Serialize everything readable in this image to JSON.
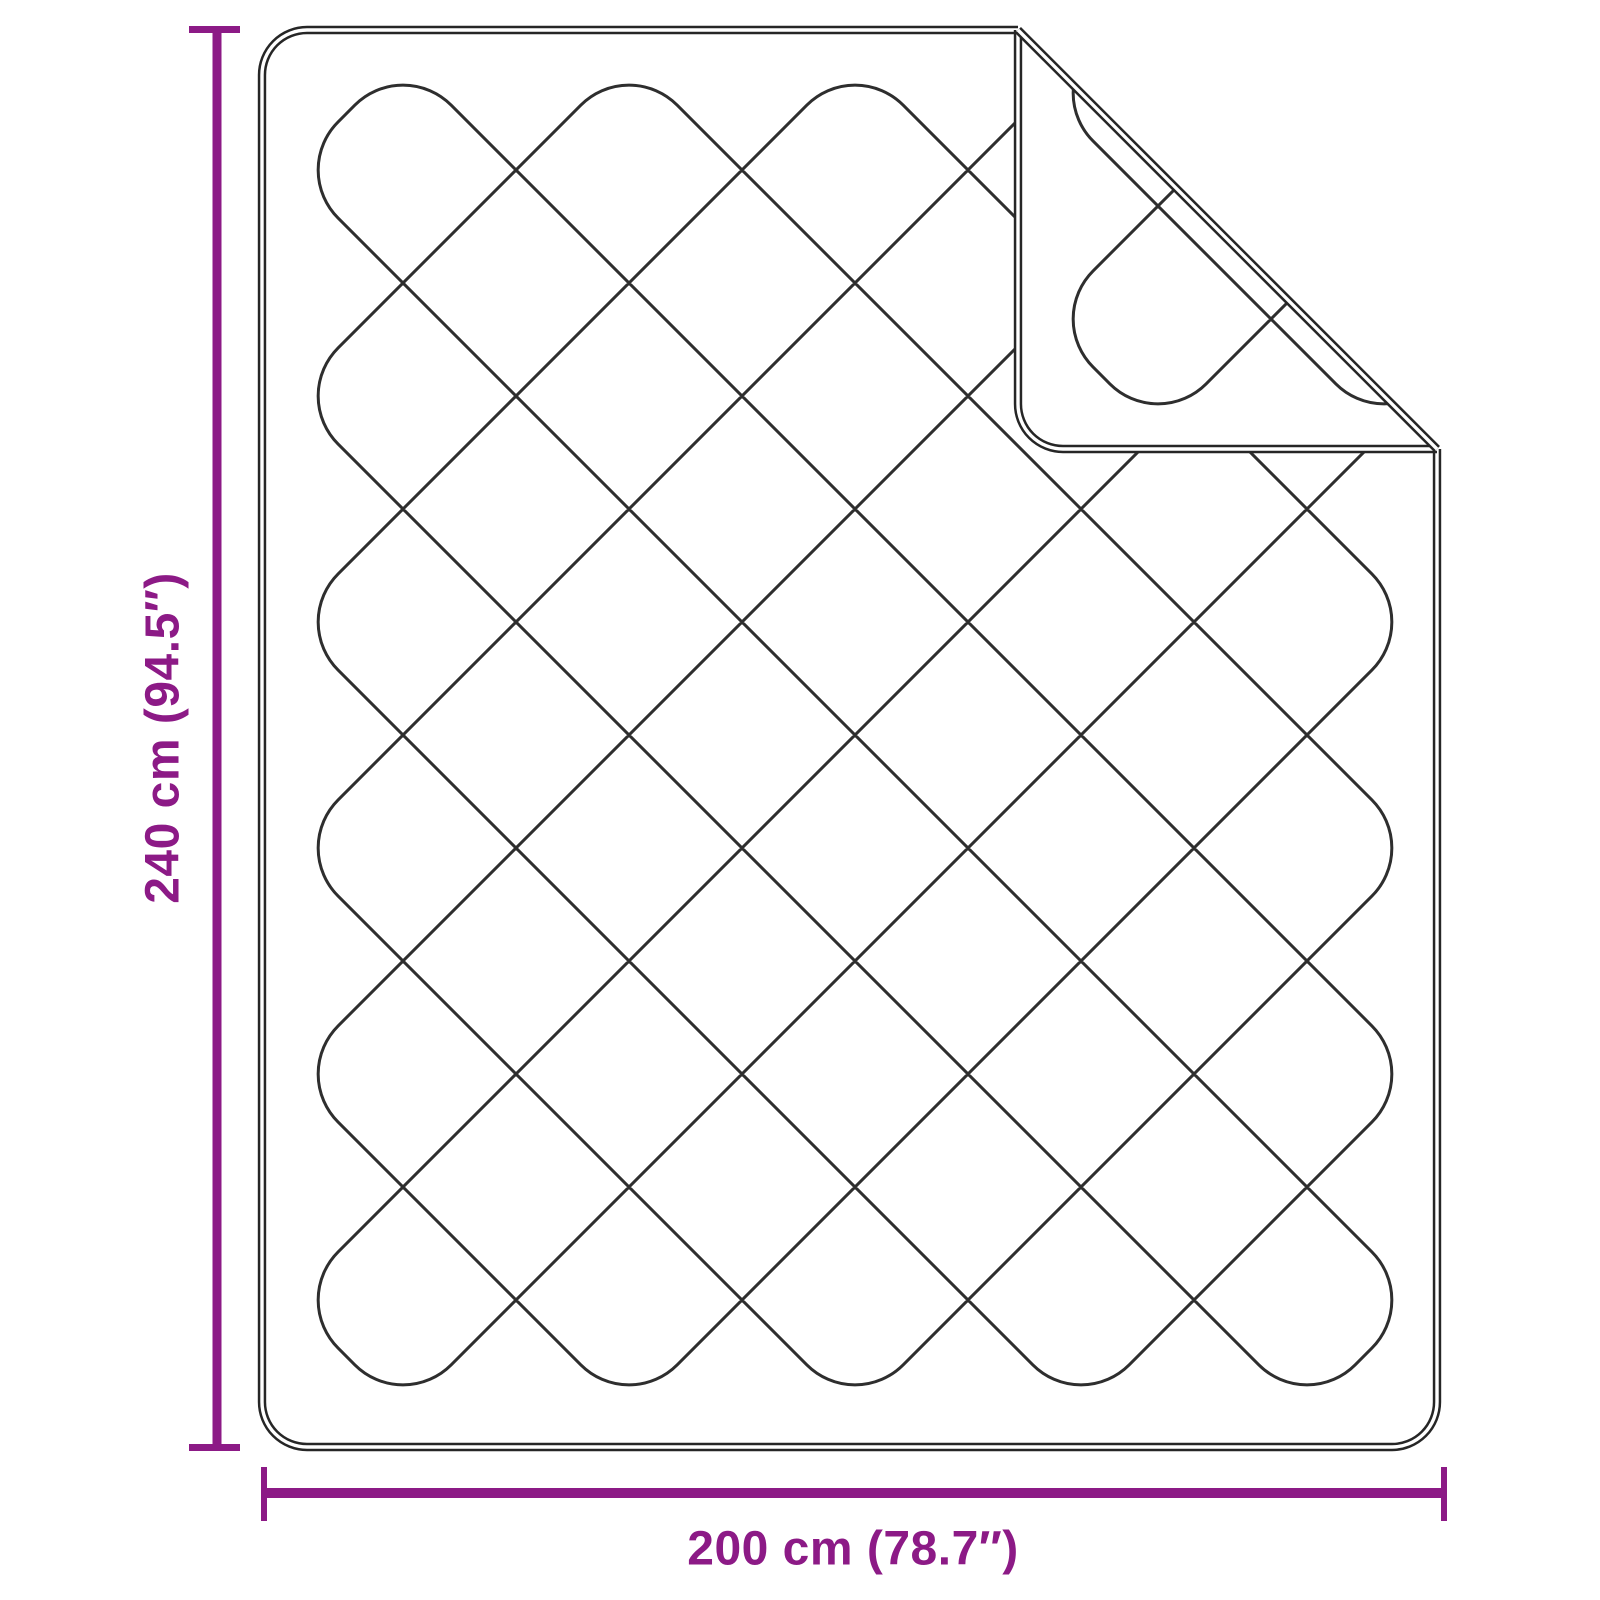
{
  "diagram": {
    "type": "product-dimension-diagram",
    "subject": "quilted blanket with folded top-right corner",
    "labels": {
      "height": "240 cm (94.5″)",
      "width": "200 cm (78.7″)"
    },
    "colors": {
      "dimension_accent": "#8C1A86",
      "outline": "#262626",
      "stitch": "#2E2E2E",
      "background": "#FFFFFF"
    },
    "blanket": {
      "outline": {
        "x": 262,
        "y": 30,
        "x2": 1437,
        "y2": 1447,
        "cornerRadius": 45
      },
      "fold": {
        "creaseOffset": 988,
        "cornerRadius": 45
      },
      "quilt": {
        "x0": 290,
        "y0": 57,
        "x1": 1420,
        "y1": 1413,
        "step": 226,
        "capRadius": 68,
        "strokeWidth": 3
      }
    },
    "dimension_lines": {
      "vertical": {
        "line": {
          "x": 212.5,
          "y": 28,
          "w": 9,
          "h": 1421
        },
        "ticks": [
          {
            "x": 189,
            "y": 26,
            "w": 51,
            "h": 7
          },
          {
            "x": 189,
            "y": 1444,
            "w": 51,
            "h": 7
          }
        ]
      },
      "horizontal": {
        "line": {
          "x": 264,
          "y": 1488,
          "w": 1181,
          "h": 10
        },
        "ticks": [
          {
            "x": 261,
            "y": 1467,
            "w": 6,
            "h": 54
          },
          {
            "x": 1441,
            "y": 1467,
            "w": 6,
            "h": 54
          }
        ]
      }
    }
  }
}
